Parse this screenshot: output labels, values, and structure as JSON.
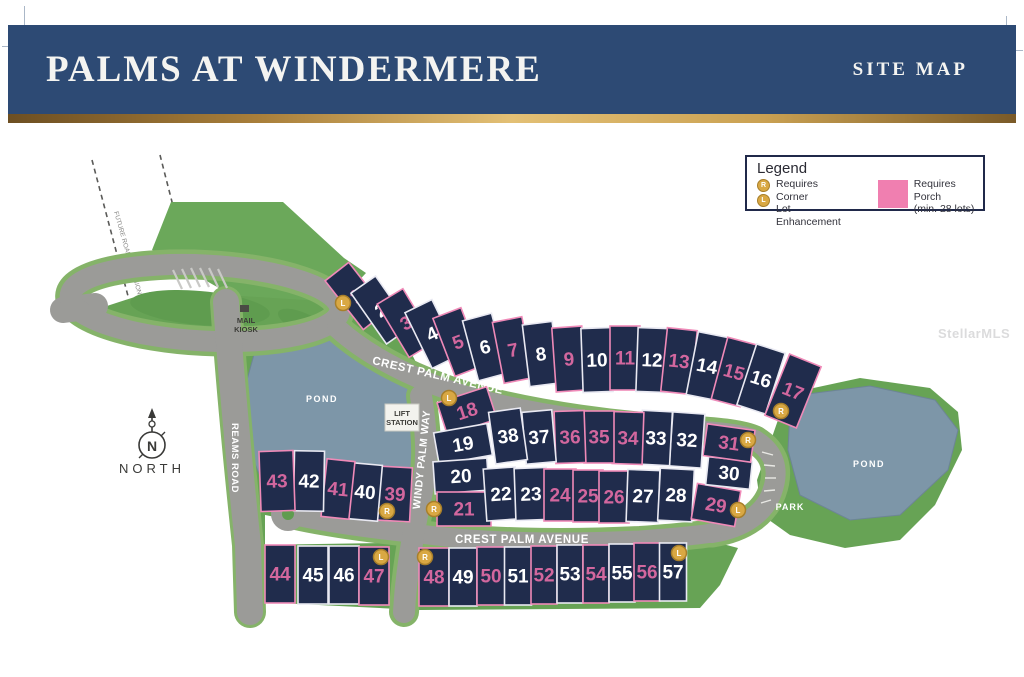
{
  "header": {
    "title": "PALMS AT WINDERMERE",
    "subtitle": "SITE MAP"
  },
  "legend": {
    "title": "Legend",
    "badge_r": "R",
    "badge_l": "L",
    "corner_line1": "Requires Corner",
    "corner_line2": "Lot Enhancement",
    "porch_line1": "Requires Porch",
    "porch_line2": "(min. 28 lots)",
    "porch_color": "#f07fb0"
  },
  "map": {
    "watermark": "StellarMLS",
    "labels": {
      "crest_palm": "CREST PALM AVENUE",
      "windy_palm": "WINDY PALM WAY",
      "reams_road": "REAMS ROAD",
      "pond": "POND",
      "park": "PARK",
      "mail_line1": "MAIL",
      "mail_line2": "KIOSK",
      "lift_line1": "LIFT",
      "lift_line2": "STATION",
      "north": "NORTH",
      "north_n": "N",
      "future_road": "FUTURE ROAD EXPANSION"
    },
    "colors": {
      "lot_fill": "#202c4c",
      "porch_stroke": "#ef8ab8",
      "porch_text": "#d2679e",
      "plain_stroke": "#e9e9f2",
      "plain_text": "#ffffff",
      "badge_fill": "#d9a843",
      "badge_ring": "#a87f2a",
      "green": "#67a355",
      "road": "#9b9b98",
      "pond": "#7d96a8"
    },
    "lots": [
      {
        "n": 1,
        "x": 356,
        "y": 296,
        "w": 30,
        "h": 62,
        "r": -38,
        "p": true,
        "b": "L",
        "bx": 343,
        "by": 303
      },
      {
        "n": 2,
        "x": 381,
        "y": 310,
        "w": 30,
        "h": 62,
        "r": -35,
        "p": false
      },
      {
        "n": 3,
        "x": 406,
        "y": 323,
        "w": 30,
        "h": 62,
        "r": -31,
        "p": true
      },
      {
        "n": 4,
        "x": 432,
        "y": 334,
        "w": 30,
        "h": 62,
        "r": -26,
        "p": false
      },
      {
        "n": 5,
        "x": 458,
        "y": 342,
        "w": 30,
        "h": 62,
        "r": -21,
        "p": true
      },
      {
        "n": 6,
        "x": 485,
        "y": 347,
        "w": 30,
        "h": 62,
        "r": -15,
        "p": false
      },
      {
        "n": 7,
        "x": 513,
        "y": 350,
        "w": 30,
        "h": 62,
        "r": -11,
        "p": true
      },
      {
        "n": 8,
        "x": 541,
        "y": 354,
        "w": 30,
        "h": 62,
        "r": -7,
        "p": false
      },
      {
        "n": 9,
        "x": 569,
        "y": 359,
        "w": 30,
        "h": 64,
        "r": -4,
        "p": true
      },
      {
        "n": 10,
        "x": 597,
        "y": 360,
        "w": 30,
        "h": 64,
        "r": -2,
        "p": false
      },
      {
        "n": 11,
        "x": 625,
        "y": 358,
        "w": 30,
        "h": 64,
        "r": 0,
        "p": true
      },
      {
        "n": 12,
        "x": 652,
        "y": 360,
        "w": 30,
        "h": 64,
        "r": 2,
        "p": false
      },
      {
        "n": 13,
        "x": 679,
        "y": 361,
        "w": 30,
        "h": 64,
        "r": 6,
        "p": true
      },
      {
        "n": 14,
        "x": 707,
        "y": 366,
        "w": 30,
        "h": 64,
        "r": 11,
        "p": false
      },
      {
        "n": 15,
        "x": 734,
        "y": 372,
        "w": 30,
        "h": 64,
        "r": 15,
        "p": true
      },
      {
        "n": 16,
        "x": 761,
        "y": 379,
        "w": 30,
        "h": 64,
        "r": 18,
        "p": false
      },
      {
        "n": 17,
        "x": 793,
        "y": 391,
        "w": 34,
        "h": 66,
        "r": 22,
        "p": true,
        "b": "R",
        "bx": 781,
        "by": 411
      },
      {
        "n": 18,
        "x": 467,
        "y": 411,
        "w": 52,
        "h": 34,
        "r": -18,
        "p": true,
        "b": "L",
        "bx": 449,
        "by": 398
      },
      {
        "n": 19,
        "x": 463,
        "y": 444,
        "w": 54,
        "h": 32,
        "r": -10,
        "p": false
      },
      {
        "n": 20,
        "x": 461,
        "y": 476,
        "w": 54,
        "h": 32,
        "r": -4,
        "p": false
      },
      {
        "n": 21,
        "x": 464,
        "y": 509,
        "w": 54,
        "h": 34,
        "r": 0,
        "p": true,
        "b": "R",
        "bx": 434,
        "by": 509
      },
      {
        "n": 22,
        "x": 501,
        "y": 494,
        "w": 32,
        "h": 52,
        "r": -4,
        "p": false
      },
      {
        "n": 23,
        "x": 531,
        "y": 494,
        "w": 32,
        "h": 52,
        "r": -2,
        "p": false
      },
      {
        "n": 24,
        "x": 560,
        "y": 495,
        "w": 32,
        "h": 52,
        "r": 0,
        "p": true
      },
      {
        "n": 25,
        "x": 588,
        "y": 496,
        "w": 30,
        "h": 52,
        "r": 0,
        "p": true
      },
      {
        "n": 26,
        "x": 614,
        "y": 497,
        "w": 30,
        "h": 52,
        "r": 0,
        "p": true
      },
      {
        "n": 27,
        "x": 643,
        "y": 496,
        "w": 32,
        "h": 52,
        "r": 2,
        "p": false
      },
      {
        "n": 28,
        "x": 676,
        "y": 495,
        "w": 34,
        "h": 52,
        "r": 3,
        "p": false
      },
      {
        "n": 29,
        "x": 716,
        "y": 505,
        "w": 44,
        "h": 36,
        "r": 10,
        "p": true,
        "b": "L",
        "bx": 738,
        "by": 510
      },
      {
        "n": 30,
        "x": 729,
        "y": 473,
        "w": 44,
        "h": 28,
        "r": 6,
        "p": false
      },
      {
        "n": 31,
        "x": 729,
        "y": 443,
        "w": 48,
        "h": 32,
        "r": 8,
        "p": true,
        "b": "R",
        "bx": 748,
        "by": 440
      },
      {
        "n": 32,
        "x": 687,
        "y": 440,
        "w": 32,
        "h": 54,
        "r": 4,
        "p": false
      },
      {
        "n": 33,
        "x": 656,
        "y": 438,
        "w": 30,
        "h": 54,
        "r": 3,
        "p": false
      },
      {
        "n": 34,
        "x": 628,
        "y": 438,
        "w": 30,
        "h": 52,
        "r": 2,
        "p": true
      },
      {
        "n": 35,
        "x": 599,
        "y": 437,
        "w": 30,
        "h": 52,
        "r": 0,
        "p": true
      },
      {
        "n": 36,
        "x": 570,
        "y": 437,
        "w": 30,
        "h": 52,
        "r": -2,
        "p": true
      },
      {
        "n": 37,
        "x": 539,
        "y": 437,
        "w": 30,
        "h": 52,
        "r": -5,
        "p": false
      },
      {
        "n": 38,
        "x": 508,
        "y": 436,
        "w": 32,
        "h": 52,
        "r": -8,
        "p": false
      },
      {
        "n": 39,
        "x": 395,
        "y": 494,
        "w": 32,
        "h": 54,
        "r": 3,
        "p": true,
        "b": "R",
        "bx": 387,
        "by": 511
      },
      {
        "n": 40,
        "x": 365,
        "y": 492,
        "w": 30,
        "h": 56,
        "r": 5,
        "p": false
      },
      {
        "n": 41,
        "x": 338,
        "y": 489,
        "w": 28,
        "h": 58,
        "r": 6,
        "p": true
      },
      {
        "n": 42,
        "x": 309,
        "y": 481,
        "w": 30,
        "h": 60,
        "r": 1,
        "p": false
      },
      {
        "n": 43,
        "x": 277,
        "y": 481,
        "w": 34,
        "h": 60,
        "r": -2,
        "p": true
      },
      {
        "n": 44,
        "x": 280,
        "y": 574,
        "w": 30,
        "h": 58,
        "r": 0,
        "p": true
      },
      {
        "n": 45,
        "x": 313,
        "y": 575,
        "w": 30,
        "h": 58,
        "r": 0,
        "p": false
      },
      {
        "n": 46,
        "x": 344,
        "y": 575,
        "w": 30,
        "h": 58,
        "r": 0,
        "p": false
      },
      {
        "n": 47,
        "x": 374,
        "y": 576,
        "w": 30,
        "h": 58,
        "r": 0,
        "p": true,
        "b": "L",
        "bx": 381,
        "by": 557
      },
      {
        "n": 48,
        "x": 434,
        "y": 577,
        "w": 30,
        "h": 58,
        "r": 0,
        "p": true,
        "b": "R",
        "bx": 425,
        "by": 557
      },
      {
        "n": 49,
        "x": 463,
        "y": 577,
        "w": 28,
        "h": 58,
        "r": 0,
        "p": false
      },
      {
        "n": 50,
        "x": 491,
        "y": 576,
        "w": 28,
        "h": 58,
        "r": 0,
        "p": true
      },
      {
        "n": 51,
        "x": 518,
        "y": 576,
        "w": 27,
        "h": 58,
        "r": 0,
        "p": false
      },
      {
        "n": 52,
        "x": 544,
        "y": 575,
        "w": 26,
        "h": 58,
        "r": 0,
        "p": true
      },
      {
        "n": 53,
        "x": 570,
        "y": 574,
        "w": 26,
        "h": 58,
        "r": 0,
        "p": false
      },
      {
        "n": 54,
        "x": 596,
        "y": 574,
        "w": 26,
        "h": 58,
        "r": 0,
        "p": true
      },
      {
        "n": 55,
        "x": 622,
        "y": 573,
        "w": 26,
        "h": 58,
        "r": 0,
        "p": false
      },
      {
        "n": 56,
        "x": 647,
        "y": 572,
        "w": 26,
        "h": 58,
        "r": 0,
        "p": true
      },
      {
        "n": 57,
        "x": 673,
        "y": 572,
        "w": 27,
        "h": 58,
        "r": 0,
        "p": false,
        "b": "L",
        "bx": 679,
        "by": 553
      }
    ]
  }
}
